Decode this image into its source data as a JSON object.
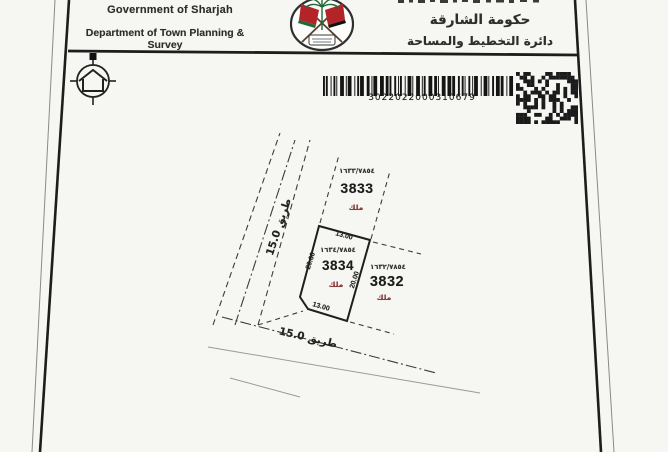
{
  "header": {
    "gov_en": "Government of Sharjah",
    "dept_en": "Department of Town Planning & Survey",
    "gov_ar": "حكومة الشارقة",
    "dept_ar": "دائرة التخطيط والمساحة"
  },
  "barcode": {
    "value": "3022022000310679"
  },
  "icons": {
    "emblem": "sharjah-government-emblem",
    "north": "north-orientation-symbol",
    "qr": "data-matrix-code"
  },
  "map": {
    "roads": [
      {
        "label": "طريق 15.0",
        "width": "15.0",
        "position": "left-diagonal"
      },
      {
        "label": "طريق 15.0",
        "width": "15.0",
        "position": "bottom"
      }
    ],
    "plots": [
      {
        "id": "3834",
        "ref": "١٦٣٤/٧٨٥٤",
        "tenure": "ملك",
        "subject": true,
        "dims": {
          "top": "13.00",
          "bottom": "13.00",
          "left": "20.00",
          "right": "20.00"
        }
      },
      {
        "id": "3833",
        "ref": "١٦٣٣/٧٨٥٤",
        "tenure": "ملك",
        "subject": false
      },
      {
        "id": "3832",
        "ref": "١٦٣٢/٧٨٥٤",
        "tenure": "ملك",
        "subject": false
      }
    ]
  },
  "colors": {
    "ink": "#2d2d2d",
    "tenure_red": "#8a3434",
    "flag_red": "#b32428",
    "palm_green": "#1f6b33",
    "paper": "#f6f6f2"
  }
}
